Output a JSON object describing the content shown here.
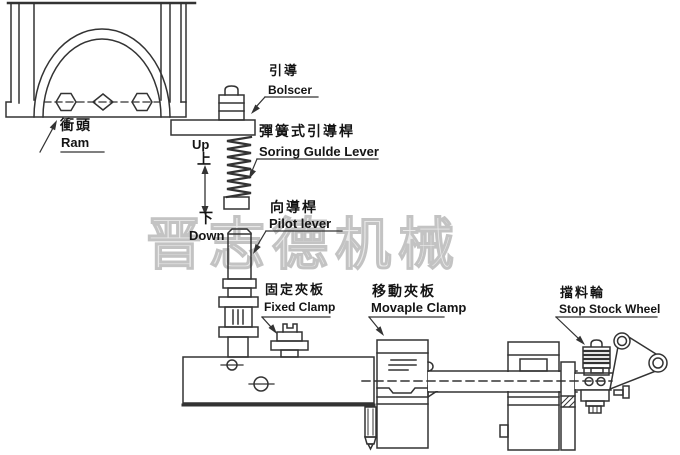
{
  "diagram": {
    "watermark": "晋志德机械",
    "parts": [
      {
        "id": "ram",
        "zh": "衝頭",
        "en": "Ram"
      },
      {
        "id": "bolscer",
        "zh": "引導",
        "en": "Bolscer"
      },
      {
        "id": "spring-guide-lever",
        "zh": "彈簧式引導桿",
        "en": "Soring Gulde Lever"
      },
      {
        "id": "pilot-lever",
        "zh": "向導桿",
        "en": "Pilot lever"
      },
      {
        "id": "fixed-clamp",
        "zh": "固定夾板",
        "en": "Fixed Clamp"
      },
      {
        "id": "movable-clamp",
        "zh": "移動夾板",
        "en": "Movaple Clamp"
      },
      {
        "id": "stop-stock-wheel",
        "zh": "擋料輪",
        "en": "Stop Stock Wheel"
      }
    ],
    "motion": {
      "up_en": "Up",
      "up_zh": "上",
      "down_zh": "下",
      "down_en": "Down"
    },
    "colors": {
      "line": "#333333",
      "text": "#141414",
      "watermark": "#c3c3c3",
      "background": "#ffffff"
    }
  }
}
